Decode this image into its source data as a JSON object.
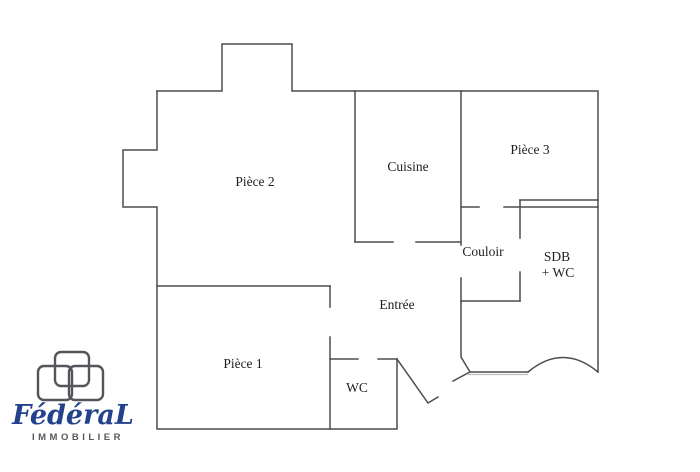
{
  "plan": {
    "title": "Floor plan",
    "rooms": {
      "piece2": {
        "label": "Pièce 2"
      },
      "cuisine": {
        "label": "Cuisine"
      },
      "piece3": {
        "label": "Pièce 3"
      },
      "couloir": {
        "label": "Couloir"
      },
      "sdb_wc": {
        "label_line1": "SDB",
        "label_line2": "+ WC"
      },
      "entree": {
        "label": "Entrée"
      },
      "piece1": {
        "label": "Pièce 1"
      },
      "wc": {
        "label": "WC"
      }
    }
  },
  "logo": {
    "brand": "FédéraL",
    "subtitle": "IMMOBILIER"
  },
  "colors": {
    "wall": "#4d4d4d",
    "wall_shadow": "#bfbfbf",
    "label": "#1f1f1f",
    "brand_blue": "#24418c",
    "brand_gray": "#58585a",
    "logo_mark": "#54545b",
    "background": "#ffffff"
  }
}
